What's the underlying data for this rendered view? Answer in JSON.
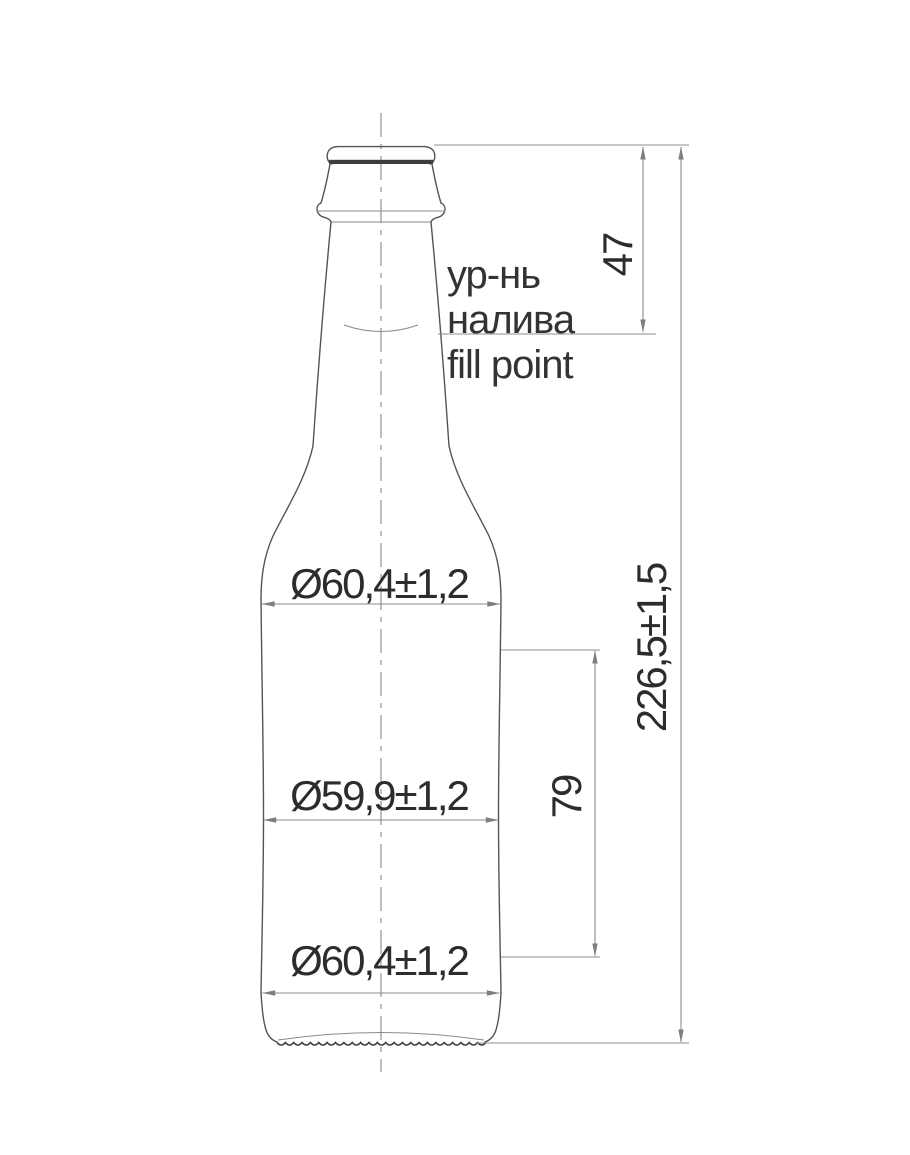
{
  "drawing": {
    "labels": {
      "fill_point_ru_1": "ур-нь",
      "fill_point_ru_2": "налива",
      "fill_point_en": "fill point"
    },
    "dimensions": {
      "fill_depth": "47",
      "overall_height": "226,5±1,5",
      "label_panel_height": "79",
      "shoulder_diameter": "Ø60,4±1,2",
      "waist_diameter": "Ø59,9±1,2",
      "base_diameter": "Ø60,4±1,2"
    },
    "colors": {
      "ink": "#2c2c2c",
      "outline": "#545454",
      "dimension_lines": "#8c8c8c",
      "background": "#ffffff"
    }
  }
}
